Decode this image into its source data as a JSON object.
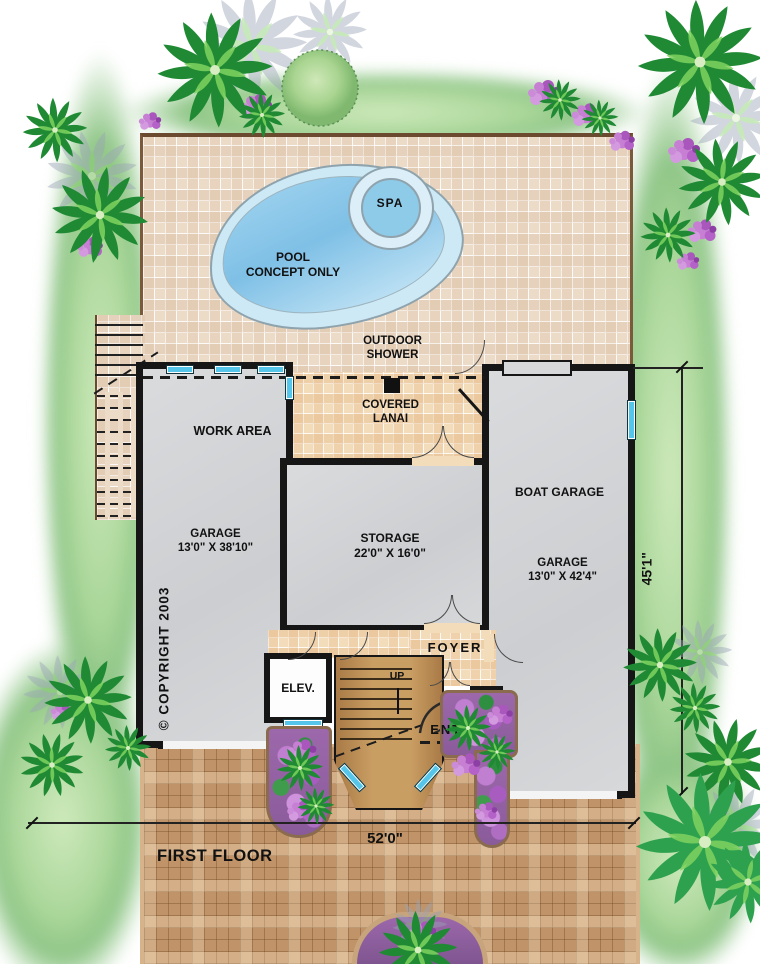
{
  "document": {
    "type": "architectural-first-floor-plan",
    "sheet_title": "FIRST FLOOR"
  },
  "labels": {
    "first_floor": "FIRST FLOOR",
    "copyright": "© COPYRIGHT 2003",
    "spa": "SPA",
    "pool_line1": "POOL",
    "pool_line2": "CONCEPT ONLY",
    "outdoor_shower_line1": "OUTDOOR",
    "outdoor_shower_line2": "SHOWER",
    "covered_lanai_line1": "COVERED",
    "covered_lanai_line2": "LANAI",
    "work_area": "WORK AREA",
    "garage_left_line1": "GARAGE",
    "garage_left_line2": "13'0\" X 38'10\"",
    "storage_line1": "STORAGE",
    "storage_line2": "22'0\" X 16'0\"",
    "boat_garage": "BOAT GARAGE",
    "garage_right_line1": "GARAGE",
    "garage_right_line2": "13'0\" X 42'4\"",
    "foyer": "FOYER",
    "elevator": "ELEV.",
    "up": "UP",
    "entry": "ENTRY"
  },
  "dimensions": {
    "lot_width": "52'0\"",
    "lot_depth": "45'1\""
  },
  "colors": {
    "deck": "#ecdbc7",
    "lanai": "#f3dcba",
    "paver": "#c09468",
    "room": "#d4d6d8",
    "wall": "#161616",
    "water": "#7fc0e6",
    "window": "#55c5e9",
    "lawn": "#aed7a0",
    "palm": "#1f8a33",
    "flower": "#b86fc6",
    "wood": "#b9854e"
  }
}
